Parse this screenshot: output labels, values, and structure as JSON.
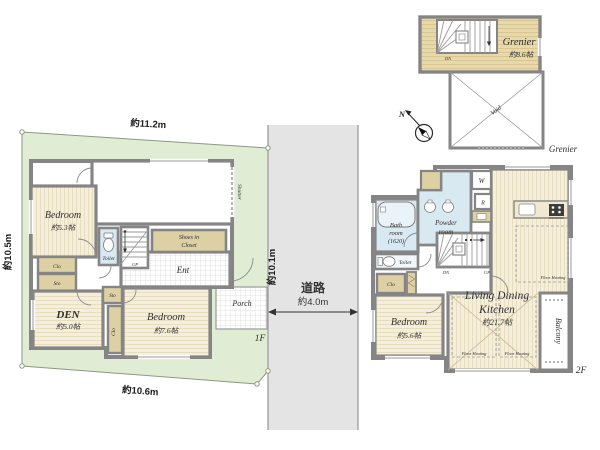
{
  "palette": {
    "land": "#e0ecd4",
    "road": "#e4e4e4",
    "wall": "#858585",
    "floor": "#f6eedd",
    "tan": "#ddd0a4",
    "blue": "#d9e9f2",
    "grenier_floor": "#e7d9ae"
  },
  "site": {
    "dim_top": "約11.2m",
    "dim_left": "約10.5m",
    "dim_bottom": "約10.6m",
    "dim_right": "約10.1m"
  },
  "road": {
    "name": "道路",
    "width": "約4.0m"
  },
  "floor1": {
    "label": "1F",
    "shutter": "Shutter",
    "bedroom1": {
      "name": "Bedroom",
      "size": "約5.3帖"
    },
    "den": {
      "name": "DEN",
      "size": "約5.0帖"
    },
    "bedroom2": {
      "name": "Bedroom",
      "size": "約7.6帖"
    },
    "toilet": "Toilet",
    "up": "UP",
    "shoes_in_closet": {
      "line1": "Shoes in",
      "line2": "Closet"
    },
    "ent": "Ent",
    "porch": "Porch",
    "clo1": "Clo",
    "sto1": "Sto",
    "sto2": "Sto",
    "clo2": "Clo"
  },
  "floor2": {
    "label": "2F",
    "bath": {
      "line1": "Bath",
      "line2": "room",
      "line3": "(1620)"
    },
    "powder": {
      "line1": "Powder",
      "line2": "room"
    },
    "washer": "W",
    "fridge": "R",
    "toilet": "Toilet",
    "clo": "Clo",
    "dn": "DN",
    "up": "UP",
    "bedroom": {
      "name": "Bedroom",
      "size": "約5.6帖"
    },
    "ldk": {
      "line1": "Living Dining",
      "line2": "Kitchen",
      "size": "約21.7帖"
    },
    "floor_heating": "Floor Heating",
    "balcony": "Balcony"
  },
  "grenier": {
    "floor_label": "Grenier",
    "room": {
      "name": "Grenier",
      "size": "約8.6帖"
    },
    "dn": "DN",
    "void": "Void",
    "north": "N"
  }
}
